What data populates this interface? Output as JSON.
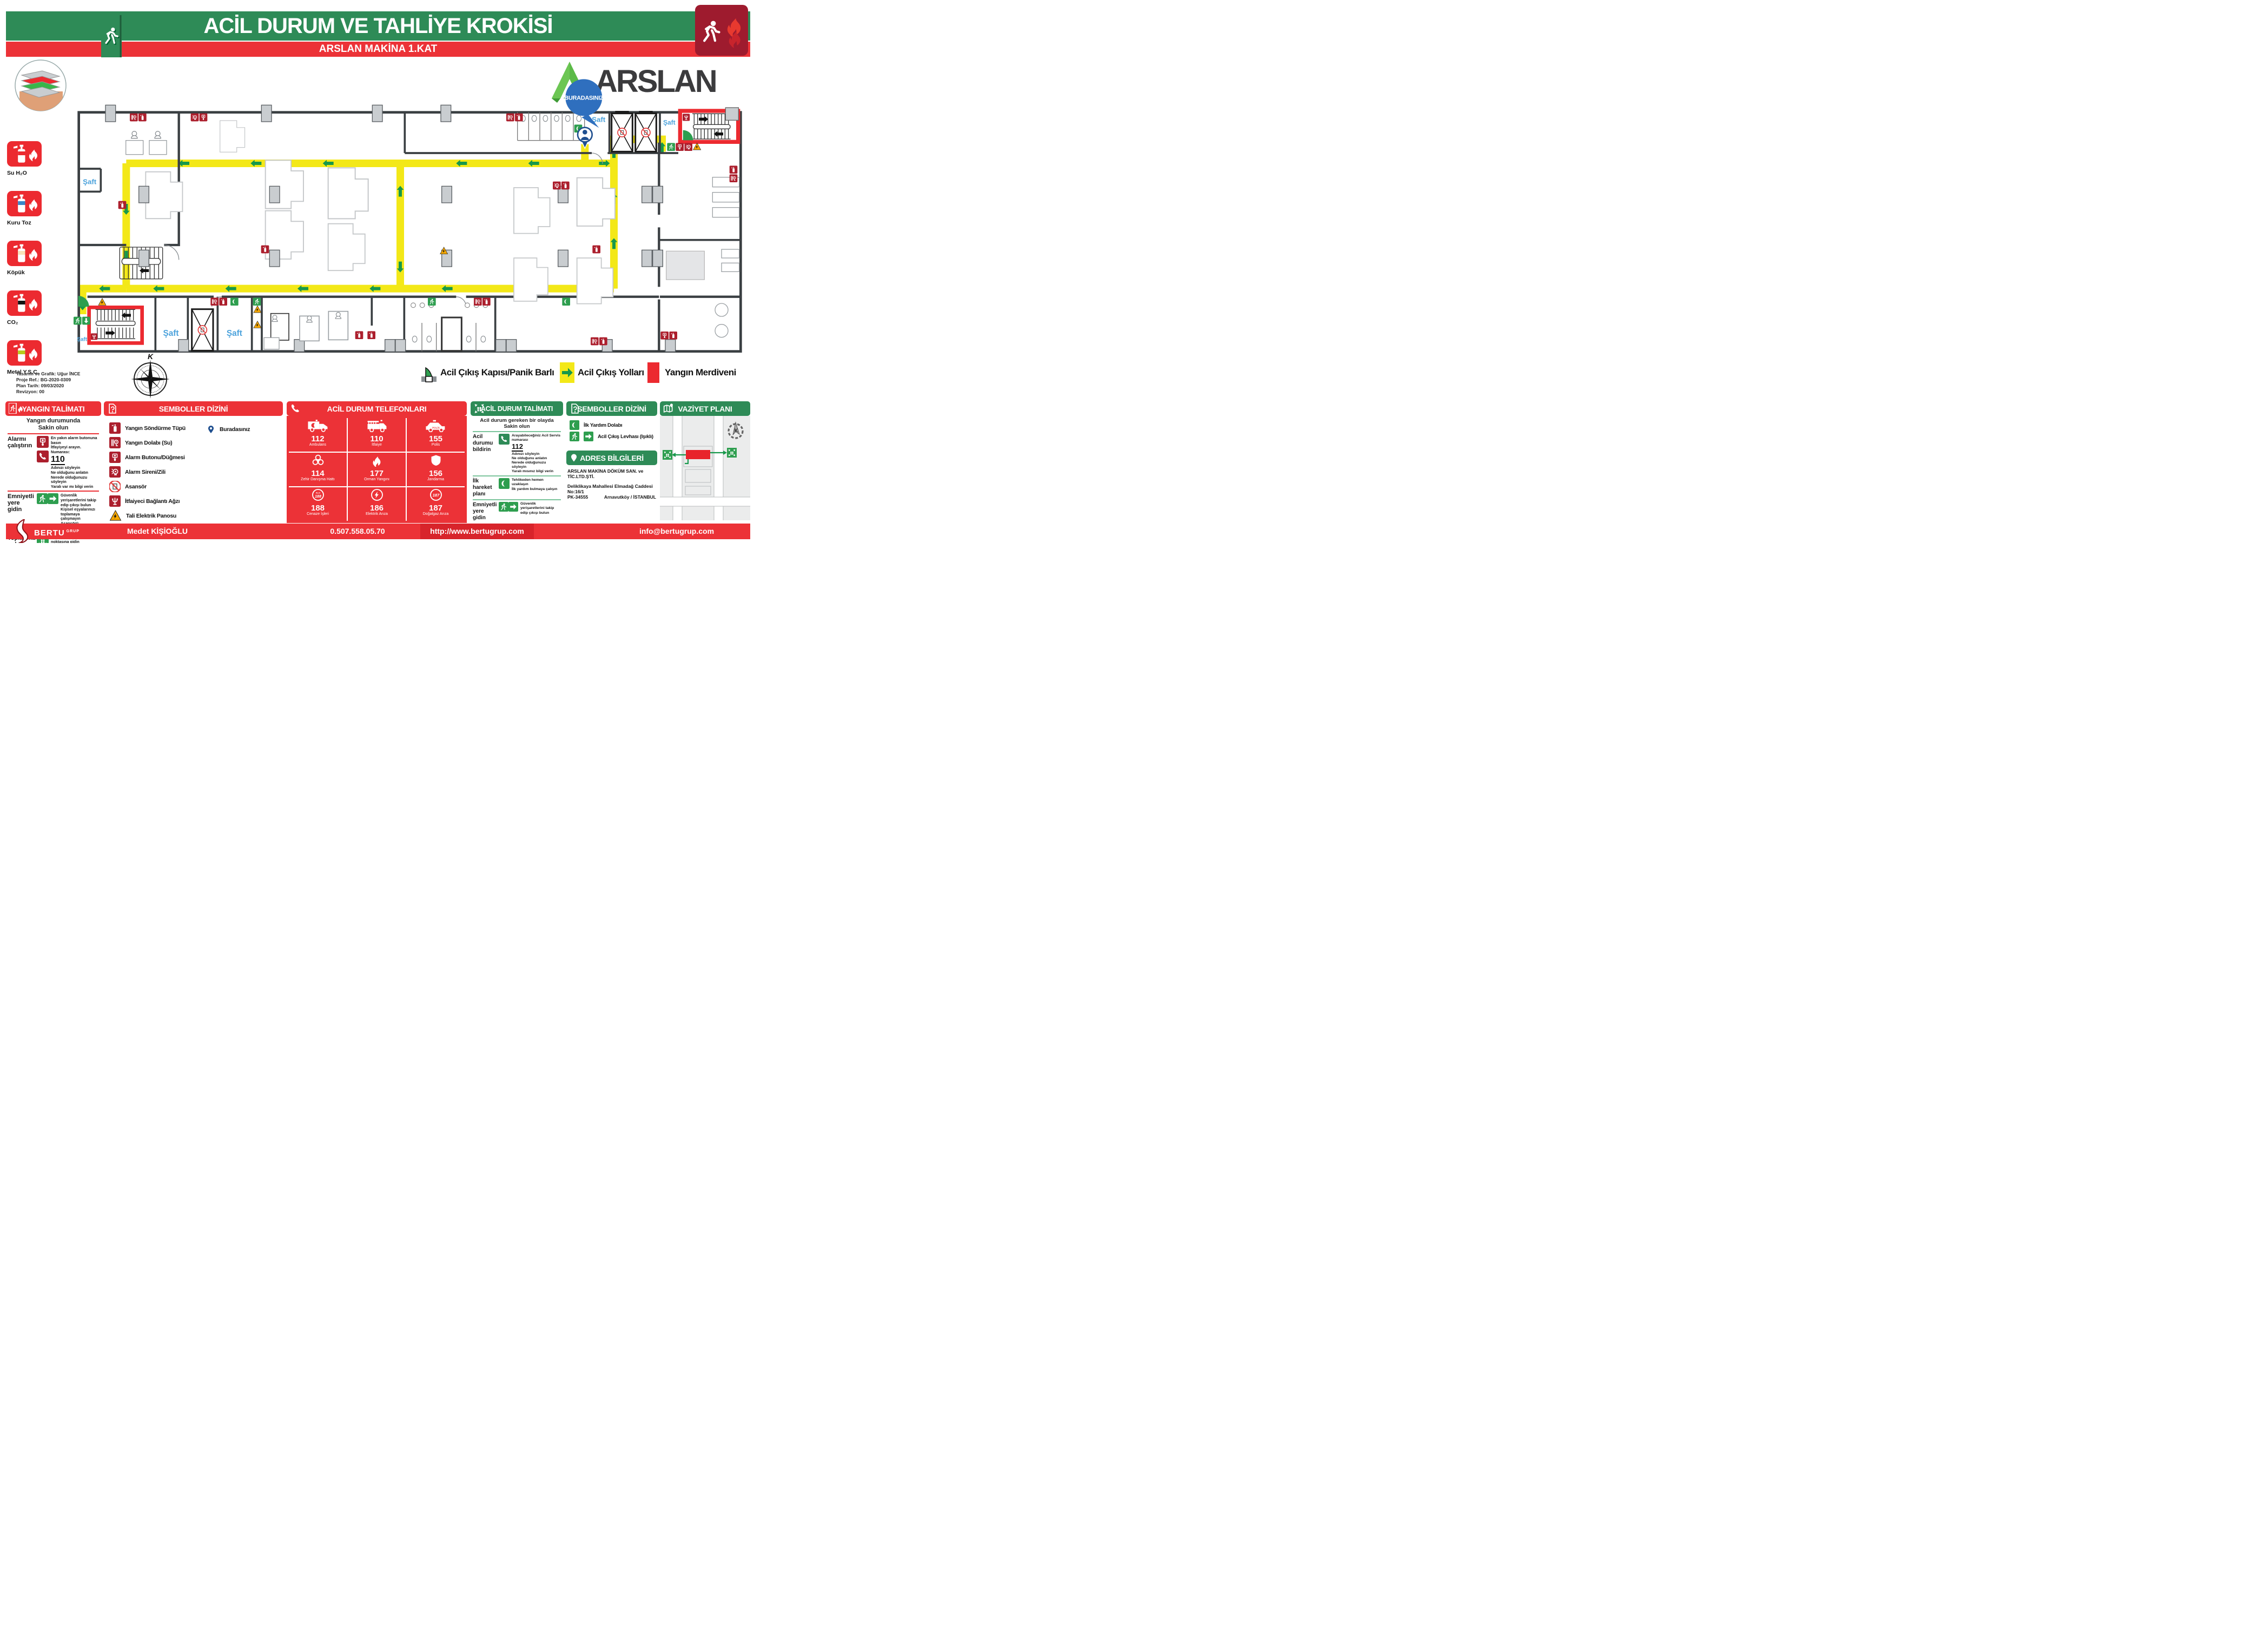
{
  "header": {
    "title": "ACİL DURUM VE TAHLİYE KROKİSİ",
    "subtitle": "ARSLAN MAKİNA 1.KAT"
  },
  "brand": {
    "name": "ARSLAN"
  },
  "plan": {
    "you_are_here": "BURADASINIZ",
    "shaft_label": "Şaft",
    "compass_letter": "K"
  },
  "extinguishers": {
    "items": [
      {
        "icon": "fire-extinguisher-icon",
        "label": "Su H₂O",
        "band_color": "#EC2A30"
      },
      {
        "icon": "fire-extinguisher-icon",
        "label": "Kuru Toz",
        "band_color": "#3B87C8"
      },
      {
        "icon": "fire-extinguisher-icon",
        "label": "Köpük",
        "band_color": "#F8E3B9"
      },
      {
        "icon": "fire-extinguisher-icon",
        "label": "CO₂",
        "band_color": "#141414"
      },
      {
        "icon": "fire-extinguisher-icon",
        "label": "Metal Y.S.C.",
        "band_color": "#B7CB1C"
      }
    ]
  },
  "info_block": {
    "line1": "Tasarım ve Grafik: Uğur İNCE",
    "line2": "Proje Ref.: BG-2020-0309",
    "line3": "Plan Tarih: 09/03/2020",
    "line4": "Revizyon: 00"
  },
  "legend": {
    "items": [
      {
        "icon": "exit-door-icon",
        "label": "Acil Çıkış Kapısı/Panik Barlı"
      },
      {
        "icon": "route-arrow-icon",
        "label": "Acil Çıkış Yolları"
      },
      {
        "icon": "fire-stair-icon",
        "label": "Yangın Merdiveni"
      }
    ]
  },
  "fire_instructions": {
    "title": "YANGIN TALİMATI",
    "intro1": "Yangın durumunda",
    "intro2": "Sakin olun",
    "rows": [
      {
        "label": "Alarmı çalıştırın",
        "text1": "En yakın alarm butonuna basın",
        "text2": "İtfayiyeyi arayın. Numarası:",
        "number": "110",
        "lines": [
          "Adınızı söyleyin",
          "Ne olduğunu anlatın",
          "Nerede olduğunuzu söyleyin",
          "Yaralı var mı bilgi verin"
        ]
      },
      {
        "label": "Emniyetli yere gidin",
        "lines": [
          "Güvenlik yerişaretlerini takip edip çıkışı bulun",
          "Kişisel eşyalarınızı toplamaya çalışmayın",
          "Asansörü kullanmayın"
        ]
      },
      {
        "label": "Toplanma noktasına gidin",
        "lines": [
          "Doğrudan toplanma noktasına gidin"
        ]
      }
    ]
  },
  "symbols_left": {
    "title": "SEMBOLLER DİZİNİ",
    "items": [
      {
        "icon": "fire-extinguisher-icon",
        "label": "Yangın Söndürme Tüpü"
      },
      {
        "icon": "fire-hose-icon",
        "label": "Yangın Dolabı (Su)"
      },
      {
        "icon": "alarm-button-icon",
        "label": "Alarm Butonu/Düğmesi"
      },
      {
        "icon": "alarm-bell-icon",
        "label": "Alarm Sireni/Zili"
      },
      {
        "icon": "no-elevator-icon",
        "label": "Asansör"
      },
      {
        "icon": "fire-connection-icon",
        "label": "İtfaiyeci Bağlantı Ağzı"
      },
      {
        "icon": "electric-panel-icon",
        "label": "Tali Elektrik Panosu"
      }
    ],
    "right_item": {
      "icon": "you-are-here-pin-icon",
      "label": "Buradasınız"
    }
  },
  "phones": {
    "title": "ACİL DURUM TELEFONLARI",
    "entries": [
      {
        "number": "112",
        "label": "Ambulans",
        "icon": "ambulance-icon"
      },
      {
        "number": "110",
        "label": "İtfaiye",
        "icon": "fire-truck-icon"
      },
      {
        "number": "155",
        "label": "Polis",
        "icon": "police-car-icon",
        "car_text": "POLİS"
      },
      {
        "number": "114",
        "label": "Zehir Danışma Hattı",
        "icon": "biohazard-icon"
      },
      {
        "number": "177",
        "label": "Orman Yangını",
        "icon": "flame-icon"
      },
      {
        "number": "156",
        "label": "Jandarma",
        "icon": "shield-icon"
      },
      {
        "number": "188",
        "label": "Cenaze İşleri",
        "icon": "alo-188-icon",
        "badge_top": "ALO",
        "badge_num": "188"
      },
      {
        "number": "186",
        "label": "Elektrik Arıza",
        "icon": "electric-fault-icon"
      },
      {
        "number": "187",
        "label": "Doğalgaz Arıza",
        "icon": "gas-187-icon",
        "badge_num": "187"
      }
    ]
  },
  "emergency_instructions": {
    "title": "ACİL DURUM TALİMATI",
    "intro1": "Acil durum gereken bir olayda",
    "intro2": "Sakin olun",
    "rows": [
      {
        "label": "Acil durumu bildirin",
        "text1": "Arayabileceğiniz Acil Servis numarası",
        "number": "112",
        "lines": [
          "Adınızı söyleyin",
          "Ne olduğunu anlatın",
          "Nerede olduğunuzu söyleyin",
          "Yaralı mısınız bilgi verin"
        ]
      },
      {
        "label": "İlk hareket planı",
        "lines": [
          "Tehlikeden hemen uzaklaşın",
          "İlk yardım bulmaya çalışın"
        ]
      },
      {
        "label": "Emniyetli yere gidin",
        "lines": [
          "Güvenlik yerişaretlerini takip edip çıkışı bulun"
        ]
      }
    ]
  },
  "symbols_right": {
    "title": "SEMBOLLER DİZİNİ",
    "items": [
      {
        "icon": "first-aid-cabinet-icon",
        "label": "İlk Yardım Dolabı"
      },
      {
        "icon": "exit-sign-icon",
        "label": "Acil Çıkış Levhası (Işıklı)"
      }
    ]
  },
  "address": {
    "title": "ADRES BİLGİLERİ",
    "company": "ARSLAN MAKİNA DÖKÜM SAN. ve TİC.LTD.ŞTİ.",
    "line1": "Deliklikaya Mahallesi Elmadağ Caddesi No:16/1",
    "line2": "PK-34555",
    "line3": "Arnavutköy / İSTANBUL"
  },
  "site_plan": {
    "title": "VAZİYET PLANI",
    "compass_letter": "K"
  },
  "footer": {
    "brand": "BERTU",
    "brand_sub": "GRUP",
    "name": "Medet KİŞİOĞLU",
    "phone": "0.507.558.05.70",
    "url": "http://www.bertugrup.com",
    "email": "info@bertugrup.com"
  },
  "colors": {
    "accent_red": "#EC3237",
    "accent_green": "#2E8B57",
    "route_yellow": "#F3E818",
    "sign_green": "#2E9E4F",
    "icon_crimson": "#AC1F2D",
    "shaft_blue": "#4DA3DC",
    "pin_blue": "#2B62A8"
  }
}
